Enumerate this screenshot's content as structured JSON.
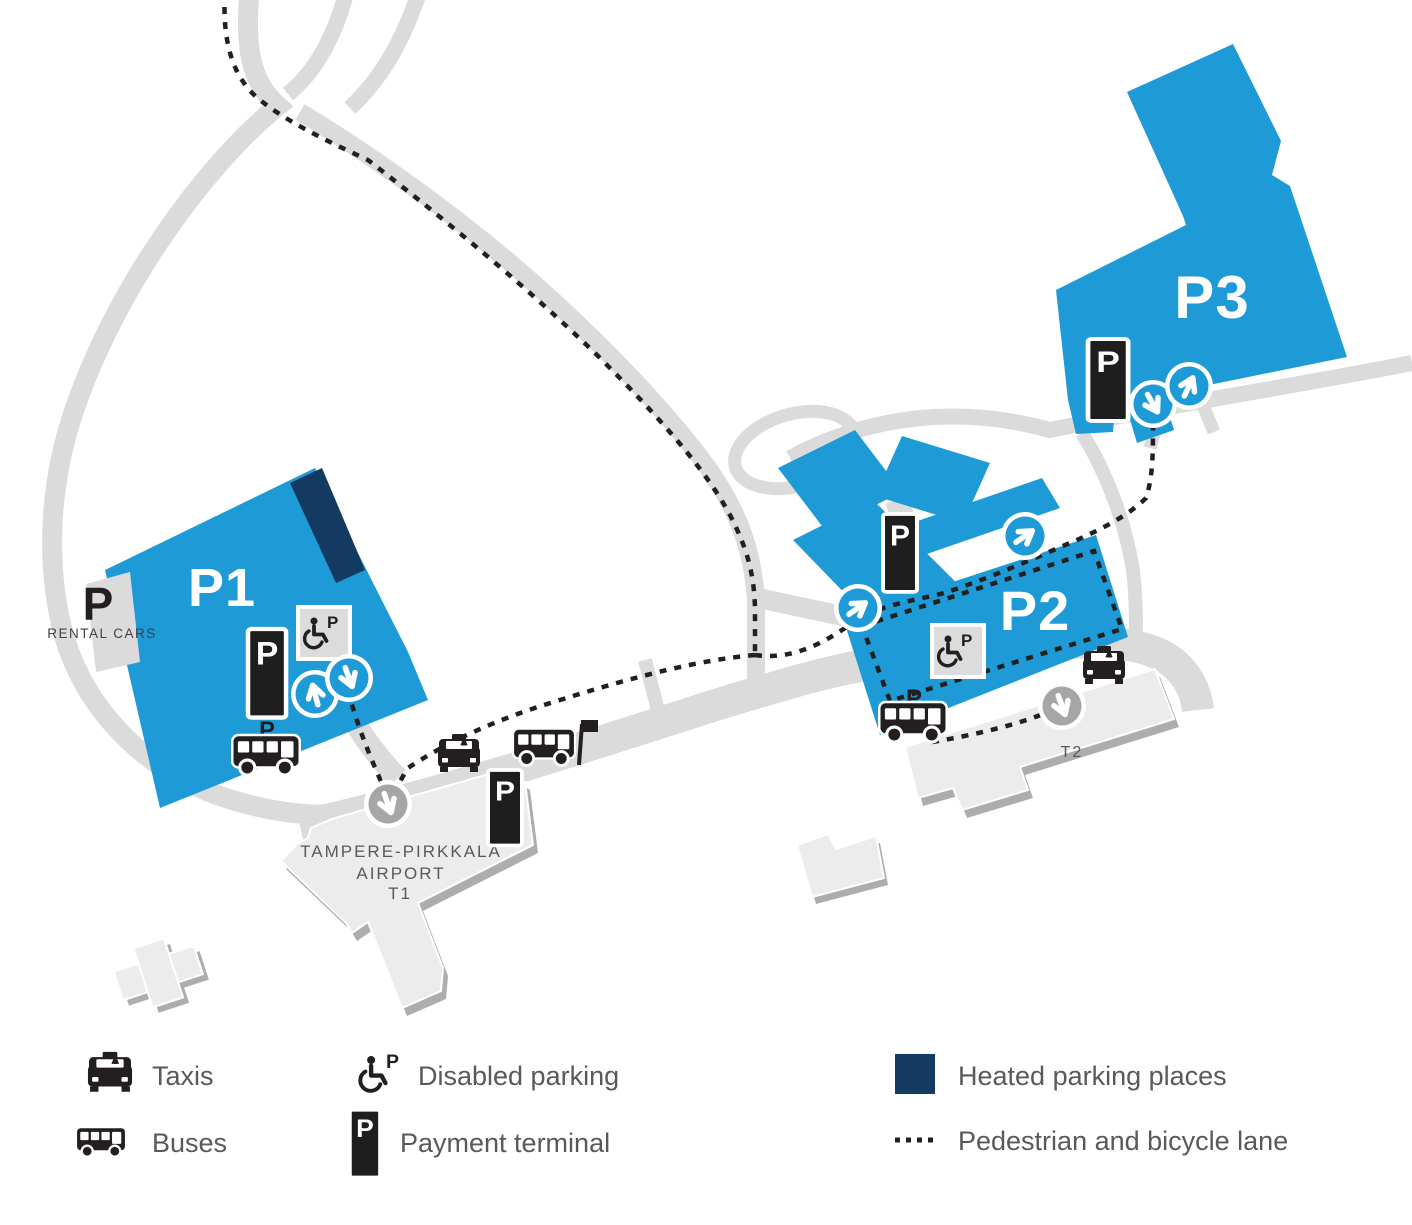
{
  "title": "Tampere-Pirkkala Airport parking map",
  "colors": {
    "blue": "#1E9BD7",
    "navy": "#133A60",
    "road": "#DBDBDB",
    "building": "#ECECEC",
    "building-shadow": "#ADADAD",
    "ink": "#231F20",
    "text-gray": "#58595B",
    "circle-gray": "#A6A6A6",
    "sign-bg": "#DCDCDC"
  },
  "map": {
    "areas": {
      "p1": "P1",
      "p2": "P2",
      "p3": "P3"
    },
    "rental_cars": {
      "p": "P",
      "label": "RENTAL CARS"
    },
    "terminal1": {
      "line1": "TAMPERE-PIRKKALA",
      "line2": "AIRPORT",
      "line3": "T1"
    },
    "terminal2": {
      "label": "T2"
    },
    "payment_p": "P",
    "disabled_p": "P",
    "bus_stop_p": "P"
  },
  "legend": {
    "taxis": "Taxis",
    "buses": "Buses",
    "disabled": "Disabled parking",
    "payment": "Payment terminal",
    "heated": "Heated parking places",
    "pedestrian": "Pedestrian and bicycle lane"
  }
}
